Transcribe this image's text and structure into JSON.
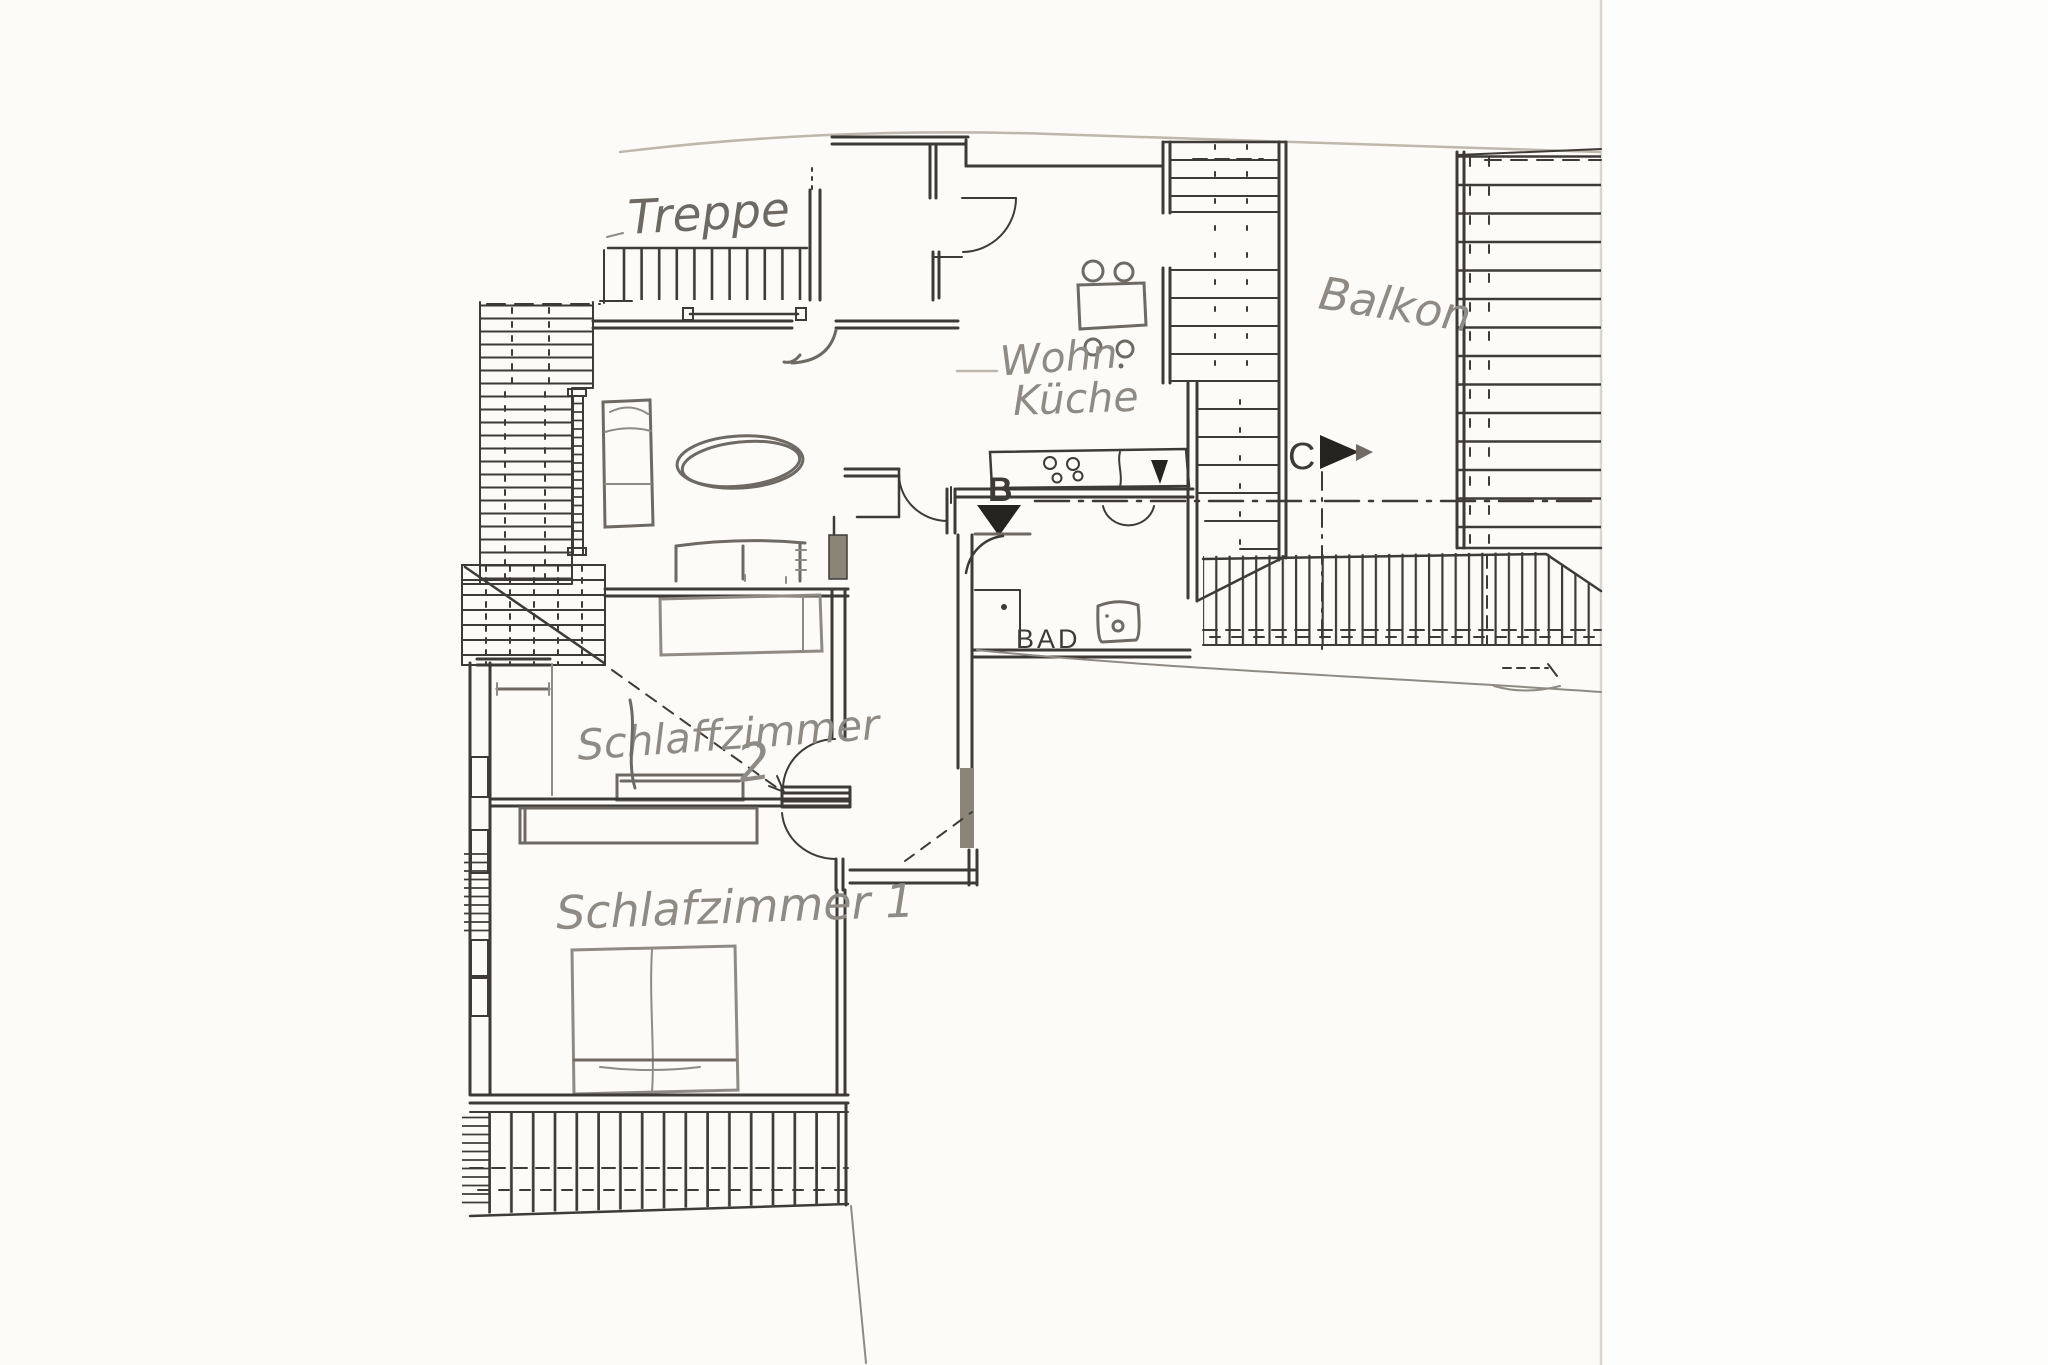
{
  "document": {
    "kind": "scanned hand-drawn apartment floor plan"
  },
  "labels": {
    "treppe": "Treppe",
    "wohn": "Wohn",
    "kueche": "Küche",
    "balkon": "Balkon",
    "bad": "BAD",
    "schlafzimmer2": "Schlaffzimmer",
    "schlafzimmer2_number": "2",
    "schlafzimmer1": "Schlafzimmer 1",
    "marker_b": "B",
    "marker_c": "C"
  },
  "colors": {
    "ink": "#3e3b37",
    "pencil": "#8f8b84",
    "pencildark": "#6e6a63",
    "faint": "#bdb7ac",
    "marker": "#262421",
    "shade": "#8b8478",
    "paper": "#fcfbf8",
    "pageedge": "#d9d5cf"
  }
}
